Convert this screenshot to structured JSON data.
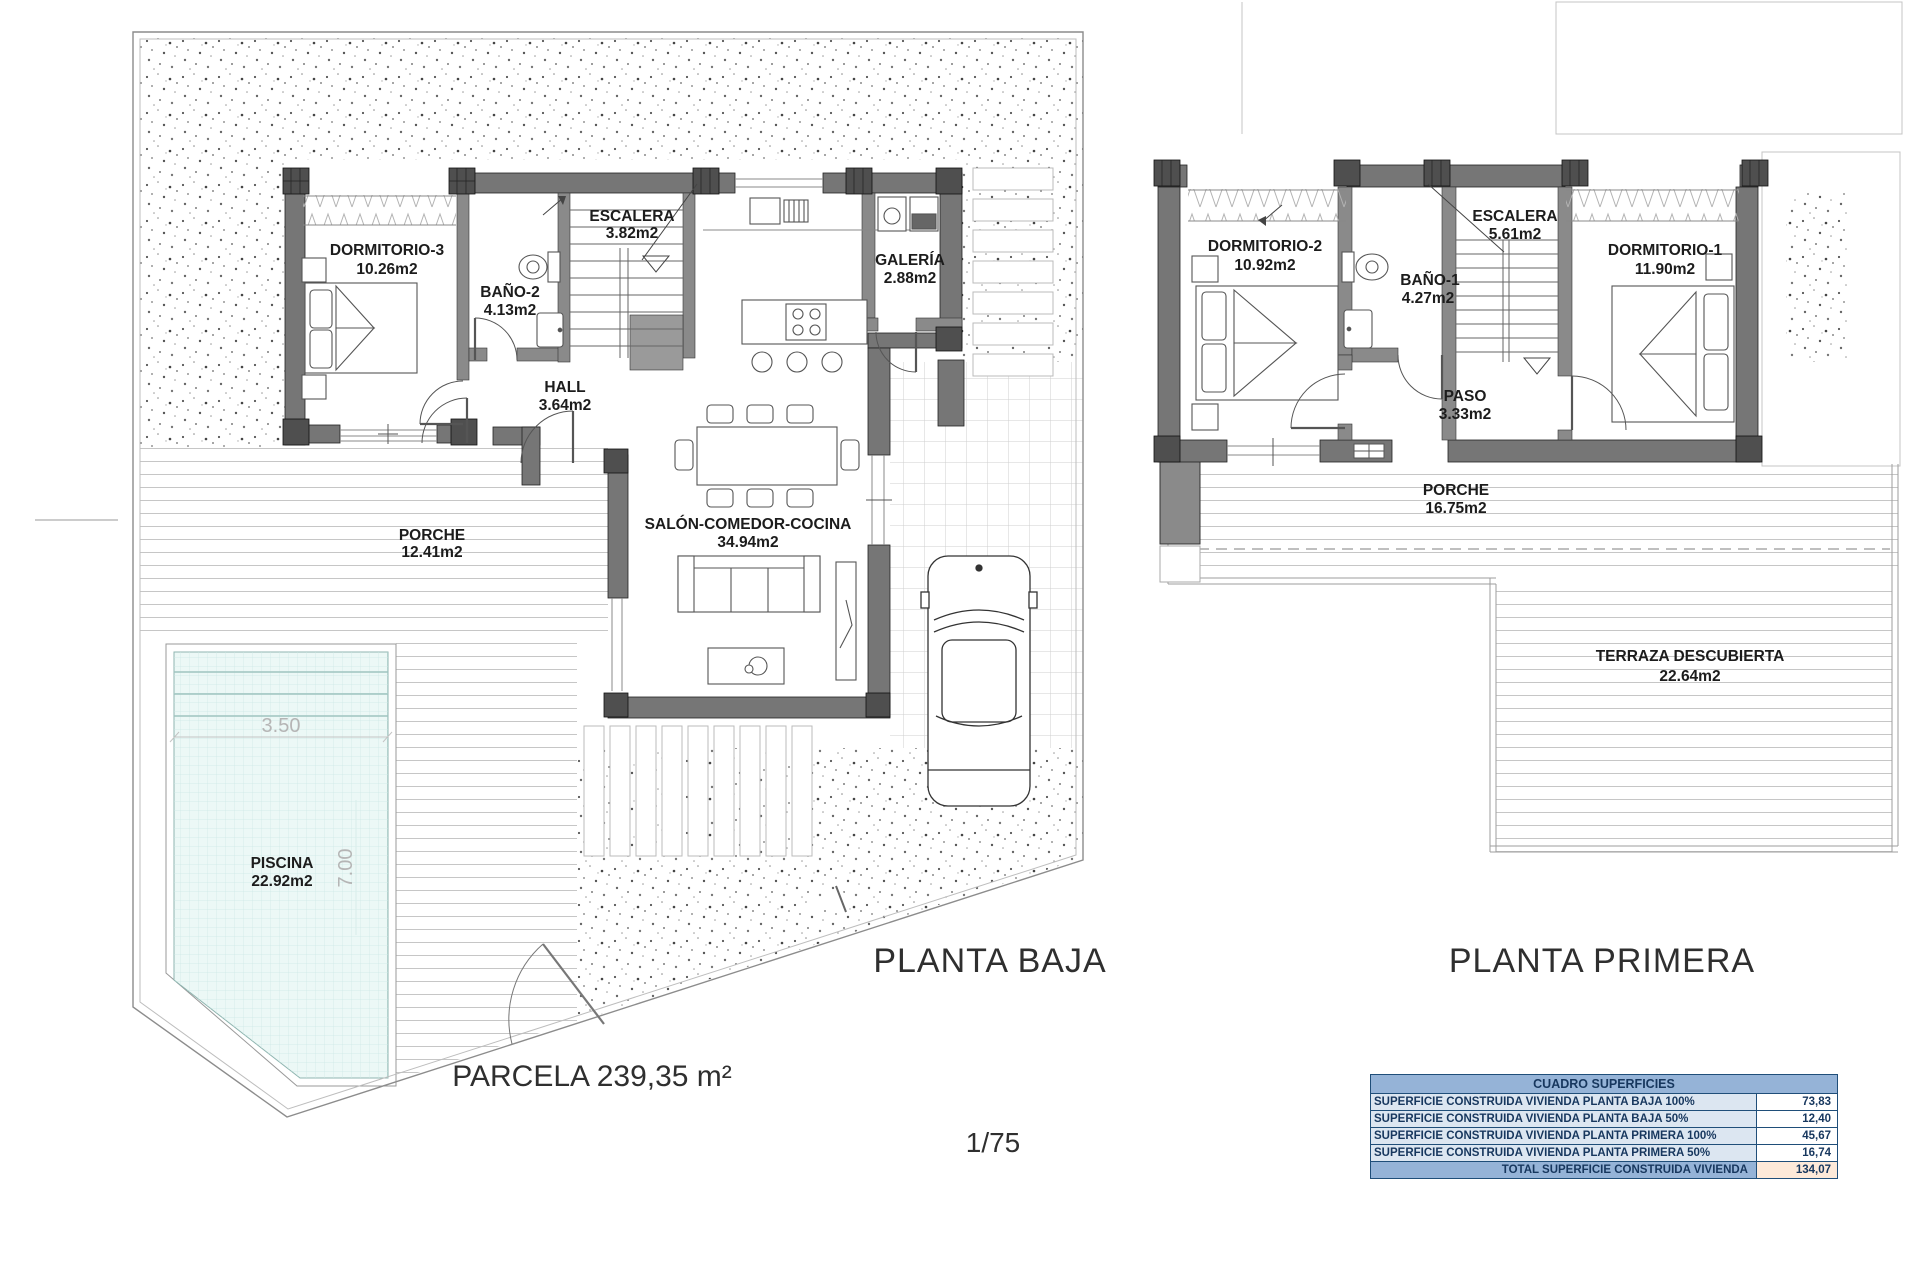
{
  "ground_floor": {
    "title": "PLANTA BAJA",
    "parcel_label": "PARCELA 239,35 m²",
    "scale_label": "1/75",
    "rooms": {
      "dormitorio3": {
        "name": "DORMITORIO-3",
        "area": "10.26m2"
      },
      "bano2": {
        "name": "BAÑO-2",
        "area": "4.13m2"
      },
      "escalera": {
        "name": "ESCALERA",
        "area": "3.82m2"
      },
      "galeria": {
        "name": "GALERÍA",
        "area": "2.88m2"
      },
      "hall": {
        "name": "HALL",
        "area": "3.64m2"
      },
      "salon": {
        "name": "SALÓN-COMEDOR-COCINA",
        "area": "34.94m2"
      },
      "porche": {
        "name": "PORCHE",
        "area": "12.41m2"
      },
      "piscina": {
        "name": "PISCINA",
        "area": "22.92m2"
      }
    },
    "pool_dimensions": {
      "width": "3.50",
      "length": "7.00"
    }
  },
  "first_floor": {
    "title": "PLANTA PRIMERA",
    "rooms": {
      "dormitorio2": {
        "name": "DORMITORIO-2",
        "area": "10.92m2"
      },
      "bano1": {
        "name": "BAÑO-1",
        "area": "4.27m2"
      },
      "escalera": {
        "name": "ESCALERA",
        "area": "5.61m2"
      },
      "dormitorio1": {
        "name": "DORMITORIO-1",
        "area": "11.90m2"
      },
      "paso": {
        "name": "PASO",
        "area": "3.33m2"
      },
      "porche": {
        "name": "PORCHE",
        "area": "16.75m2"
      },
      "terraza": {
        "name": "TERRAZA DESCUBIERTA",
        "area": "22.64m2"
      }
    }
  },
  "areas_table": {
    "header": "CUADRO SUPERFICIES",
    "rows": [
      {
        "label": "SUPERFICIE CONSTRUIDA VIVIENDA PLANTA BAJA 100%",
        "value": "73,83"
      },
      {
        "label": "SUPERFICIE CONSTRUIDA VIVIENDA PLANTA BAJA 50%",
        "value": "12,40"
      },
      {
        "label": "SUPERFICIE CONSTRUIDA VIVIENDA PLANTA PRIMERA 100%",
        "value": "45,67"
      },
      {
        "label": "SUPERFICIE CONSTRUIDA VIVIENDA PLANTA PRIMERA 50%",
        "value": "16,74"
      }
    ],
    "total_label": "TOTAL SUPERFICIE CONSTRUIDA VIVIENDA",
    "total_value": "134,07"
  },
  "colors": {
    "table_header_bg": "#95b3d7",
    "table_row_bg": "#dce6f1",
    "table_total_value_bg": "#fde9d9",
    "table_border": "#1f4e79",
    "table_text": "#17375e",
    "pool_fill": "#ecf8f6",
    "wall_fill": "#767676"
  }
}
